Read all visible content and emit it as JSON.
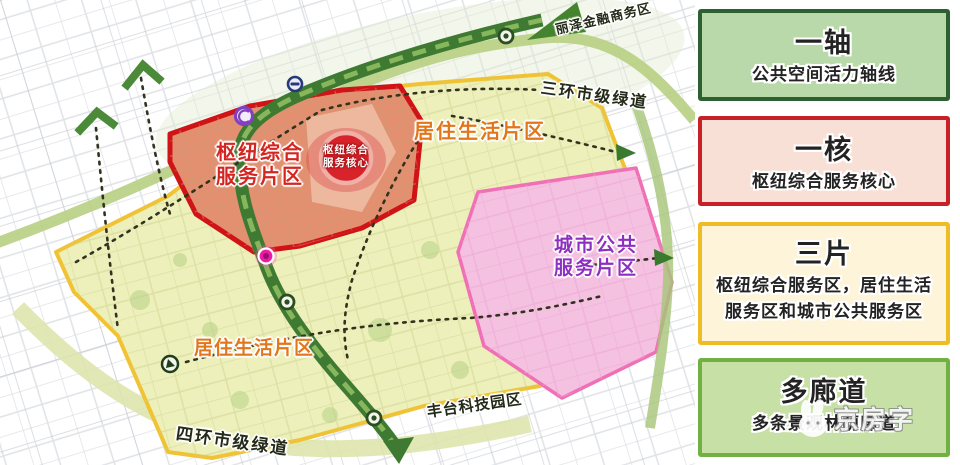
{
  "map": {
    "zones": {
      "hub": {
        "label_line1": "枢纽综合",
        "label_line2": "服务片区",
        "label_color": "#d42520"
      },
      "core": {
        "label_line1": "枢纽综合",
        "label_line2": "服务核心"
      },
      "residential_north": {
        "label": "居住生活片区"
      },
      "residential_south": {
        "label": "居住生活片区"
      },
      "public_service": {
        "label_line1": "城市公共",
        "label_line2": "服务片区",
        "label_color": "#8d2fc0"
      }
    },
    "annotations": {
      "greenway_third_ring": "三环市级绿道",
      "greenway_fourth_ring": "四环市级绿道",
      "fengtai_science_park": "丰台科技园区",
      "lize_business_district": "丽泽金融商务区"
    },
    "watermark": "京房字",
    "colors": {
      "axis_green": "#3e7a31",
      "greenway_band": "#b8cf82",
      "hub_zone_border": "#d01317",
      "hub_zone_fill": "#e29070",
      "residential_border": "#f0c335",
      "residential_fill": "#edf0ba",
      "public_zone_border": "#f070b6",
      "public_zone_fill": "#f5c1e1",
      "metro_icon_purple": "#8040bf",
      "node_magenta": "#ec1ba6",
      "core_red": "#d8232b"
    }
  },
  "legend": {
    "items": [
      {
        "title": "一轴",
        "desc": "公共空间活力轴线",
        "bg": "#b9d9aa",
        "border": "#2d6030"
      },
      {
        "title": "一核",
        "desc": "枢纽综合服务核心",
        "bg": "#f9e0d6",
        "border": "#c52127"
      },
      {
        "title": "三片",
        "desc": "枢纽综合服务区，居住生活服务区和城市公共服务区",
        "bg": "#fdf4da",
        "border": "#eebc25"
      },
      {
        "title": "多廊道",
        "desc": "多条景观林荫廊道",
        "bg": "#c6e0a5",
        "border": "#71b144"
      }
    ]
  }
}
